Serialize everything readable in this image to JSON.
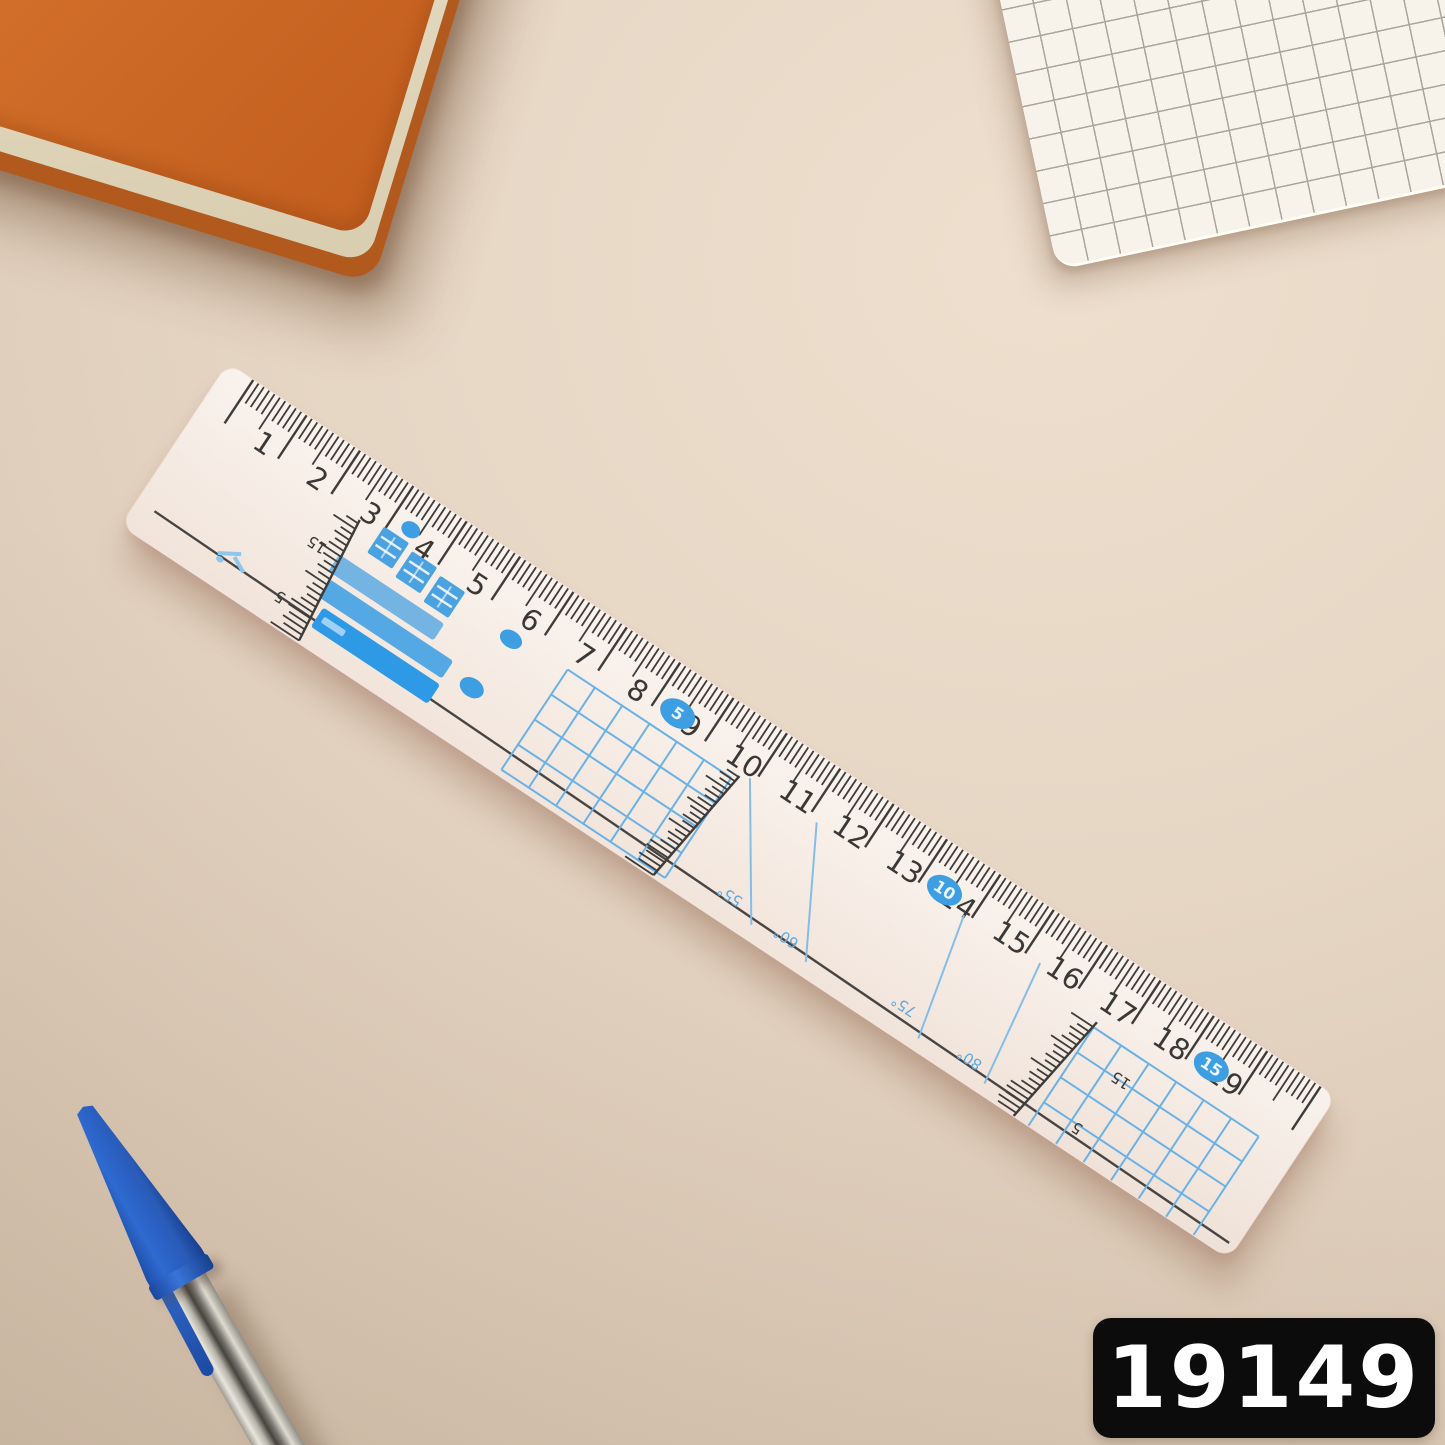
{
  "product_code": "19149",
  "scene": {
    "colors": {
      "desk_beige": "#e4d4c2",
      "notebook_orange": "#d4712c",
      "notebook_edge": "#b25a1e",
      "pad_white": "#f7f3ea",
      "pad_grid_line": "#aba69b",
      "pen_cap_blue": "#2b62c6",
      "code_badge_bg": "#0c0c0c",
      "code_badge_text": "#ffffff"
    },
    "objects": [
      "orange-hardcover-notebook",
      "white-grid-notepad",
      "transparent-sewing-ruler",
      "blue-ballpoint-pen",
      "product-code-badge"
    ]
  },
  "ruler": {
    "cm_numbers": [
      "1",
      "2",
      "3",
      "4",
      "5",
      "6",
      "7",
      "8",
      "9",
      "10",
      "11",
      "12",
      "13",
      "14",
      "15",
      "16",
      "17",
      "18",
      "19"
    ],
    "badges": [
      {
        "label": "5",
        "cm": 8.5
      },
      {
        "label": "10",
        "cm": 13.5
      },
      {
        "label": "15",
        "cm": 18.5
      }
    ],
    "angle_lines": [
      {
        "label": "55°"
      },
      {
        "label": "60°"
      },
      {
        "label": "75°"
      },
      {
        "label": "80°"
      }
    ],
    "mm_scale_labels": [
      "15",
      "5"
    ],
    "brand_mark": {
      "type": "cjk-characters-and-bars",
      "legible": false
    },
    "colors": {
      "tick": "#3e3c39",
      "number": "#3a3835",
      "print_blue": "#4aa2e0",
      "grid_blue": "#6ab2e6",
      "badge_blue": "#3e9ee2",
      "angle_blue": "#85bde9",
      "angle_text": "#5fa8e0",
      "line_dark": "#474442"
    }
  }
}
